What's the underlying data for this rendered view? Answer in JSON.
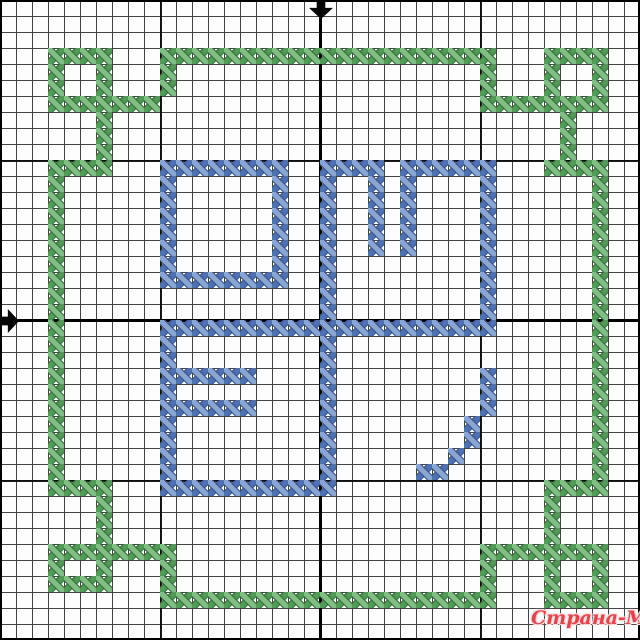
{
  "canvas": {
    "width": 640,
    "height": 640,
    "cols": 40,
    "rows": 40,
    "cell_size": 16,
    "background": "#fdfdfd"
  },
  "grid": {
    "minor_line_color": "#434343",
    "major_line_color": "#0a0a0a",
    "major_every_cells": 10,
    "center_col": 20,
    "center_row": 20,
    "center_line_color": "#000000"
  },
  "markers": {
    "color": "#050505",
    "top_arrow": {
      "direction": "down",
      "x": 309,
      "y": 1,
      "w": 24,
      "h": 18
    },
    "left_arrow": {
      "direction": "right",
      "x": 1,
      "y": 309,
      "w": 18,
      "h": 24
    }
  },
  "stitches": {
    "green": {
      "role": "border-frame",
      "color_dark": "#2d6e34",
      "color_mid": "#509c56",
      "color_light": "#82bd86",
      "h_runs": [
        [
          3,
          3,
          6
        ],
        [
          3,
          10,
          30
        ],
        [
          3,
          34,
          37
        ],
        [
          6,
          3,
          9
        ],
        [
          6,
          30,
          37
        ],
        [
          10,
          3,
          6
        ],
        [
          10,
          34,
          37
        ],
        [
          30,
          3,
          6
        ],
        [
          30,
          34,
          37
        ],
        [
          34,
          3,
          10
        ],
        [
          34,
          30,
          37
        ],
        [
          36,
          3,
          6
        ],
        [
          37,
          10,
          30
        ],
        [
          37,
          34,
          37
        ]
      ],
      "v_runs": [
        [
          3,
          3,
          6
        ],
        [
          6,
          3,
          6
        ],
        [
          34,
          3,
          6
        ],
        [
          37,
          3,
          6
        ],
        [
          10,
          4,
          5
        ],
        [
          30,
          4,
          5
        ],
        [
          6,
          7,
          9
        ],
        [
          35,
          7,
          9
        ],
        [
          3,
          10,
          30
        ],
        [
          37,
          10,
          30
        ],
        [
          6,
          31,
          33
        ],
        [
          34,
          31,
          33
        ],
        [
          3,
          34,
          36
        ],
        [
          6,
          34,
          36
        ],
        [
          34,
          34,
          37
        ],
        [
          37,
          34,
          37
        ],
        [
          10,
          35,
          36
        ],
        [
          30,
          35,
          36
        ]
      ],
      "cells": []
    },
    "blue": {
      "role": "center-monogram",
      "color_dark": "#33518a",
      "color_mid": "#4d72b2",
      "color_light": "#8aa5d1",
      "h_runs": [
        [
          10,
          10,
          17
        ],
        [
          10,
          20,
          23
        ],
        [
          10,
          25,
          30
        ],
        [
          17,
          10,
          17
        ],
        [
          20,
          10,
          30
        ],
        [
          23,
          10,
          15
        ],
        [
          25,
          10,
          15
        ],
        [
          29,
          26,
          27
        ],
        [
          30,
          10,
          20
        ]
      ],
      "v_runs": [
        [
          10,
          10,
          17
        ],
        [
          17,
          10,
          17
        ],
        [
          10,
          20,
          30
        ],
        [
          20,
          10,
          30
        ],
        [
          23,
          10,
          15
        ],
        [
          25,
          10,
          15
        ],
        [
          30,
          10,
          19
        ],
        [
          30,
          23,
          25
        ],
        [
          29,
          26,
          27
        ]
      ],
      "cells": [
        [
          28,
          28
        ]
      ]
    }
  },
  "watermark": {
    "text": "Страна-Мам",
    "color": "#e5434e",
    "outline_color": "#ffd6d6",
    "x": 531,
    "y": 607,
    "font_size": 19
  }
}
